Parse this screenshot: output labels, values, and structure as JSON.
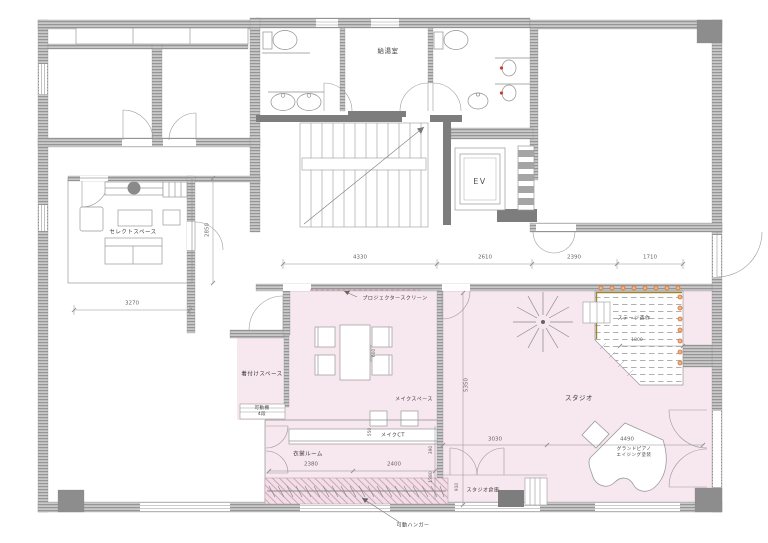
{
  "meta": {
    "type": "architectural-floor-plan",
    "floor_fill": "studio-zone-pink"
  },
  "colors": {
    "wall_hatch": "#c6c6c6",
    "wall_dark": "#7d7d7d",
    "line": "#8f8f8f",
    "pink_zone": "#f7e7ee",
    "stage_accent_olive": "#9b8433",
    "stage_dot_orange": "#d96f35",
    "screen_dash_pink": "#d98fa6",
    "dim_text": "#666666"
  },
  "rooms": {
    "kitchenette": "給湯室",
    "elevator": "EV",
    "select_space": "セレクトスペース",
    "dressing_space": "着付けスペース",
    "movable_shelf": "可動棚",
    "movable_shelf_tiers": "4段",
    "costume_room": "衣裳ルーム",
    "makeup_space": "メイクスペース",
    "makeup_counter": "メイクCT",
    "studio": "スタジオ",
    "stage": "ステージ造作",
    "studio_storage": "スタジオ倉庫"
  },
  "annotations": {
    "projector_screen": "プロジェクタースクリーン",
    "movable_hanger": "可動ハンガー",
    "grand_piano": "グランドピアノ",
    "piano_note": "エイジング塗装"
  },
  "dimensions": {
    "corridor": [
      "4330",
      "2610",
      "2390",
      "1710"
    ],
    "left_width": "3270",
    "select_depth": "2850",
    "studio_depth": "5350",
    "table_gap": "600",
    "costume": [
      "2380",
      "2400"
    ],
    "counter_depth": "550",
    "gap_small": "390",
    "hanger_depth": "1380",
    "storage_width": "3030",
    "piano_width": "4490",
    "storage_depth": "910",
    "stage_width": "1800"
  }
}
